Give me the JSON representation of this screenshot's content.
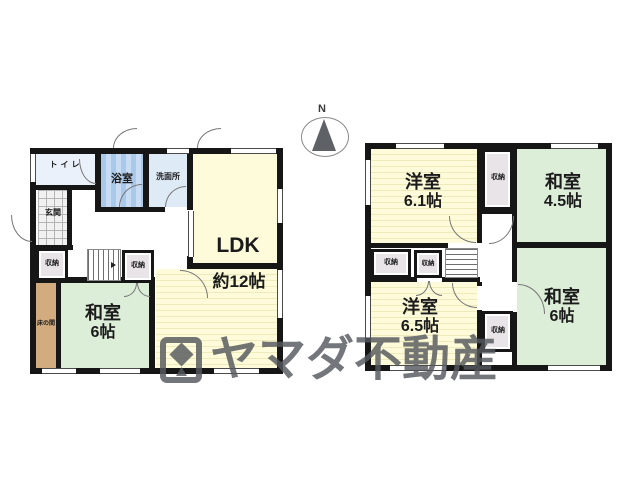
{
  "compass": {
    "north_label": "N"
  },
  "watermark": {
    "brand": "ヤマダ不動産"
  },
  "floor1": {
    "toilet": "トイレ",
    "bath": "浴室",
    "washroom": "洗面所",
    "entrance": "玄関",
    "ldk_name": "LDK",
    "ldk_size": "約12帖",
    "storage_left": "収納",
    "storage_right": "収納",
    "tokonoma": "床の間",
    "washitsu_name": "和室",
    "washitsu_size": "6帖"
  },
  "floor2": {
    "western1_name": "洋室",
    "western1_size": "6.1帖",
    "washitsu45_name": "和室",
    "washitsu45_size": "4.5帖",
    "storage_top": "収納",
    "storage_a": "収納",
    "storage_b": "収納",
    "storage_c": "収納",
    "western2_name": "洋室",
    "western2_size": "6.5帖",
    "washitsu6_name": "和室",
    "washitsu6_size": "6帖"
  },
  "colors": {
    "wall": "#161616",
    "tatami_green": "#dcedd8",
    "flooring_yellow": "#fdfbda",
    "bath_blue": "#a9c9ea",
    "washroom_blue": "#dfeaf7",
    "toilet_blue": "#ebf1fa",
    "tokonoma_tan": "#d2ab7e",
    "storage_gray": "#e8e4e8",
    "watermark_gray": "#55585d"
  }
}
